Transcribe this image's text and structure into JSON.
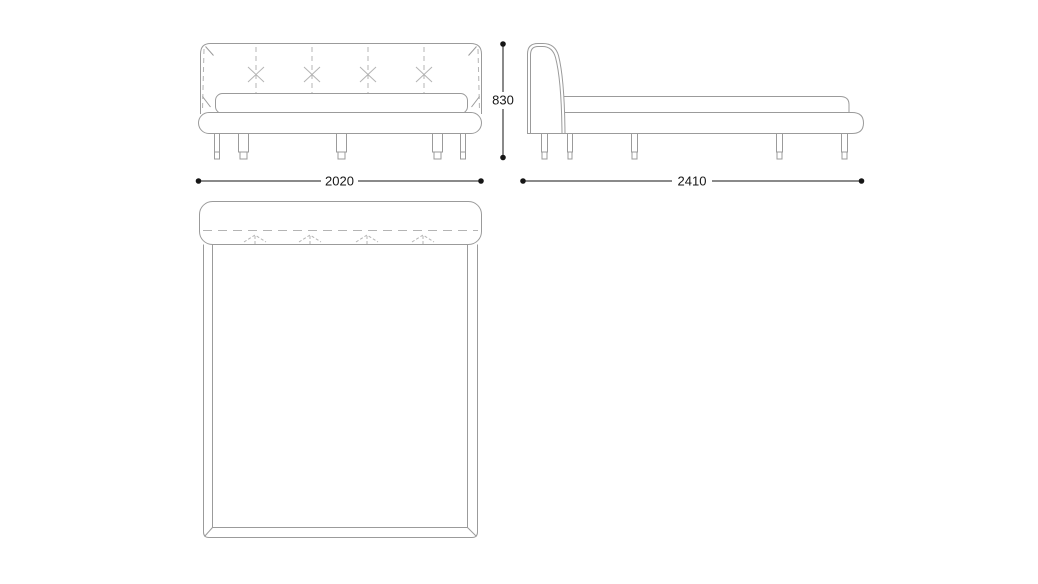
{
  "drawing": {
    "type": "furniture-technical-drawing",
    "subject": "bed",
    "views": [
      "front",
      "side",
      "plan"
    ],
    "line_color": "#9b9b9b",
    "seam_color": "#b4b4b4",
    "dimension_color": "#161616",
    "background_color": "#ffffff"
  },
  "dimensions": {
    "width": {
      "value": "2020"
    },
    "height": {
      "value": "830"
    },
    "depth": {
      "value": "2410"
    }
  }
}
